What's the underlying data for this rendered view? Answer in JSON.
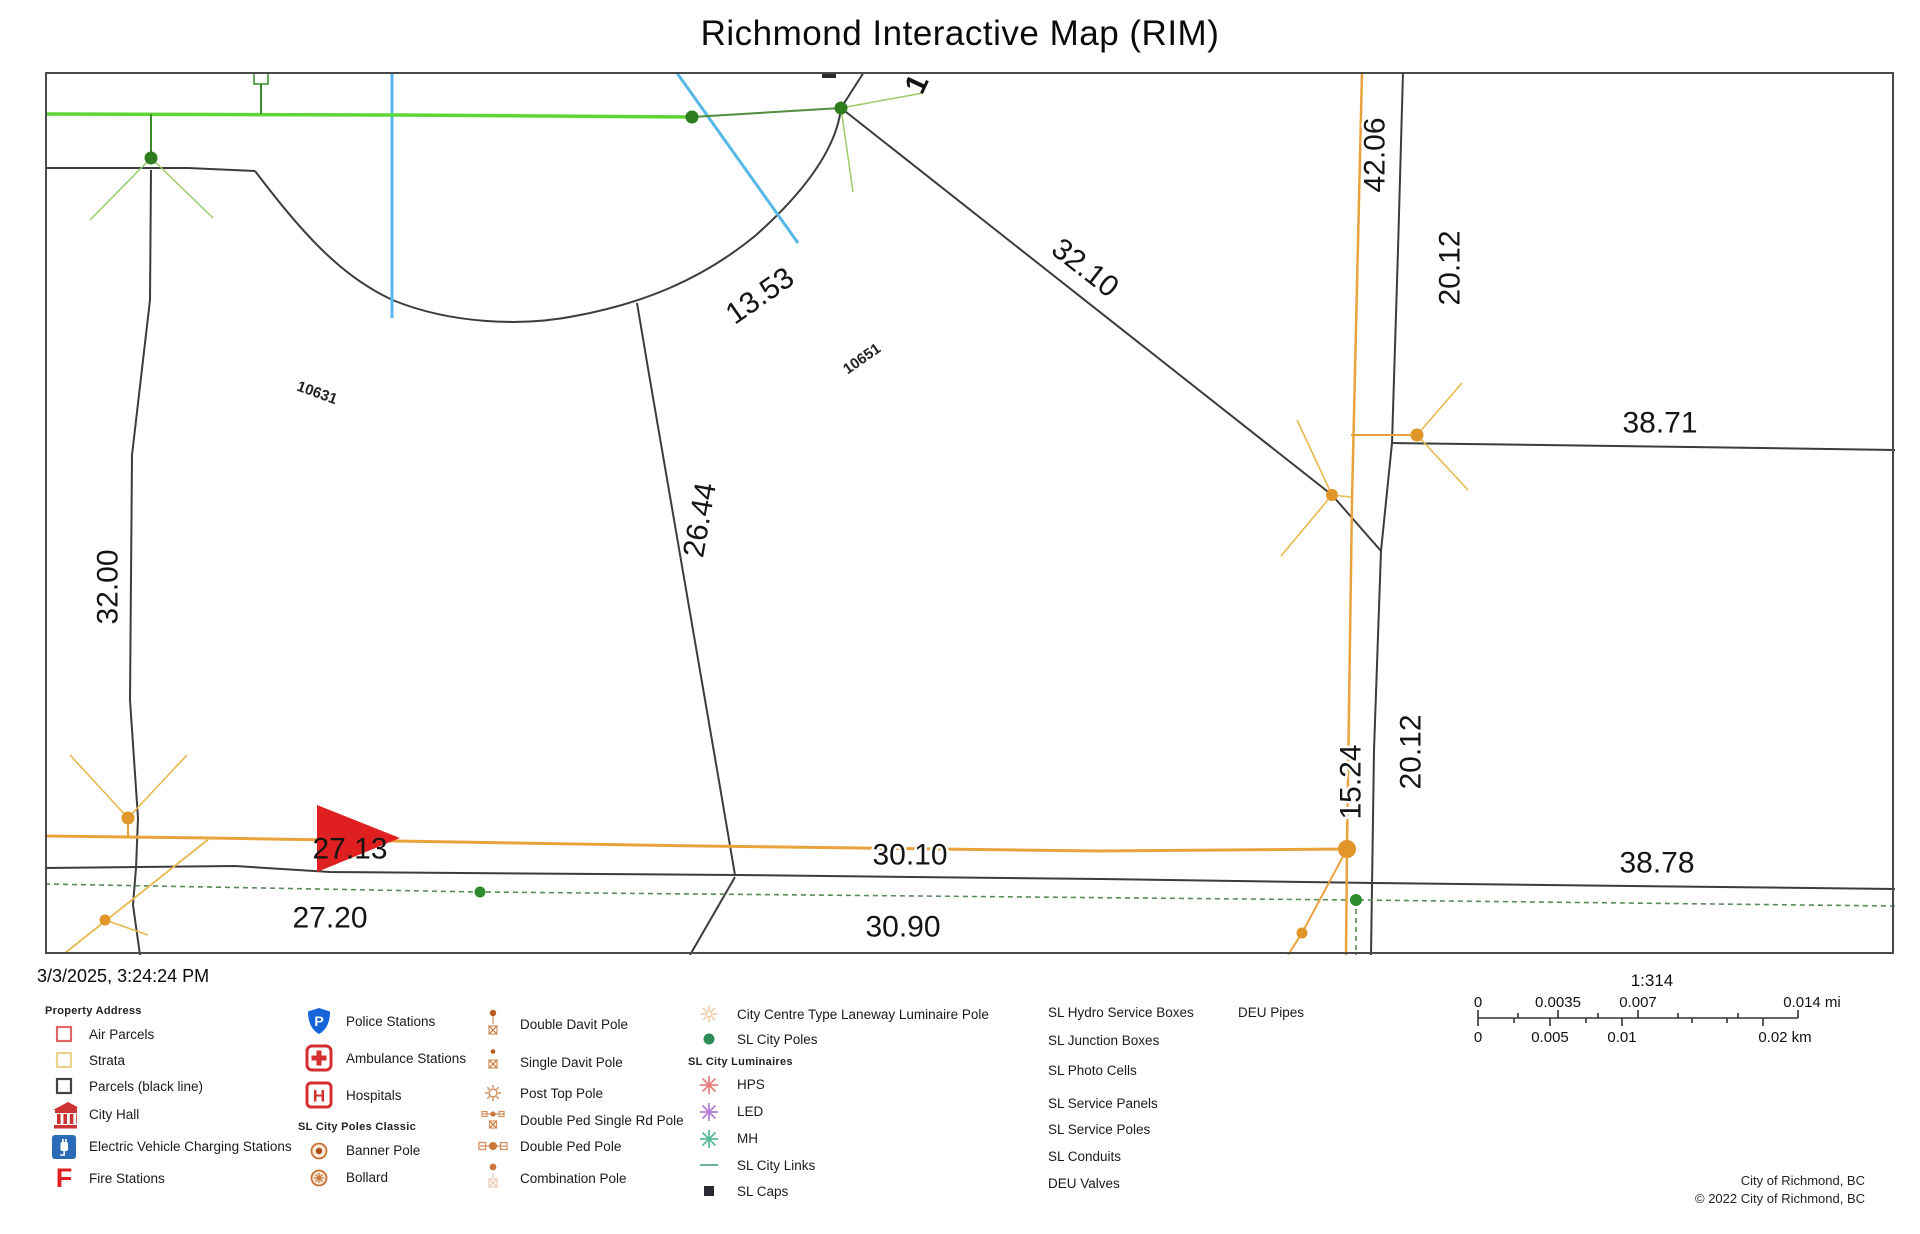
{
  "title": "Richmond Interactive Map (RIM)",
  "timestamp": "3/3/2025, 3:24:24 PM",
  "map": {
    "dims": [
      "42.06",
      "20.12",
      "32.10",
      "13.53",
      "38.71",
      "32.00",
      "26.44",
      "15.24",
      "20.12",
      "38.78",
      "27.13",
      "30.10",
      "27.20",
      "30.90"
    ],
    "partial_label": "1",
    "parcel_ids": [
      "10631",
      "10651"
    ]
  },
  "legend": {
    "col1": {
      "header": "Property Address",
      "items": [
        "Air Parcels",
        "Strata",
        "Parcels (black line)",
        "City Hall",
        "Electric Vehicle Charging Stations",
        "Fire Stations"
      ]
    },
    "col2": {
      "items": [
        "Police Stations",
        "Ambulance Stations",
        "Hospitals"
      ],
      "subheader": "SL City Poles Classic",
      "sub_items": [
        "Banner Pole",
        "Bollard"
      ]
    },
    "col3": {
      "items": [
        "Double Davit Pole",
        "Single Davit Pole",
        "Post Top Pole",
        "Double Ped Single Rd Pole",
        "Double Ped Pole",
        "Combination Pole"
      ]
    },
    "col4": {
      "items": [
        "City Centre Type Laneway Luminaire Pole",
        "SL City Poles"
      ],
      "subheader": "SL City Luminaires",
      "sub_items": [
        "HPS",
        "LED",
        "MH"
      ],
      "items2": [
        "SL City Links",
        "SL Caps"
      ]
    },
    "col5": {
      "items": [
        "SL Hydro Service Boxes",
        "SL Junction Boxes",
        "SL Photo Cells",
        "SL Service Panels",
        "SL Service Poles",
        "SL Conduits",
        "DEU Valves"
      ]
    },
    "col6": {
      "items": [
        "DEU Pipes"
      ]
    }
  },
  "scale": {
    "ratio": "1:314",
    "mi_labels": [
      "0",
      "0.0035",
      "0.007",
      "0.014 mi"
    ],
    "km_labels": [
      "0",
      "0.005",
      "0.01",
      "0.02 km"
    ]
  },
  "credits": {
    "line1": "City of Richmond, BC",
    "line2": "© 2022 City of Richmond, BC"
  },
  "colors": {
    "parcel_line": "#3c3c3c",
    "utility_orange": "#e8a33d",
    "pole_dot_orange": "#e09628",
    "green_line": "#5fd435",
    "sl_pole_green": "#2e7d1e",
    "water_blue": "#55b8e8",
    "marker_red": "#e02020"
  }
}
